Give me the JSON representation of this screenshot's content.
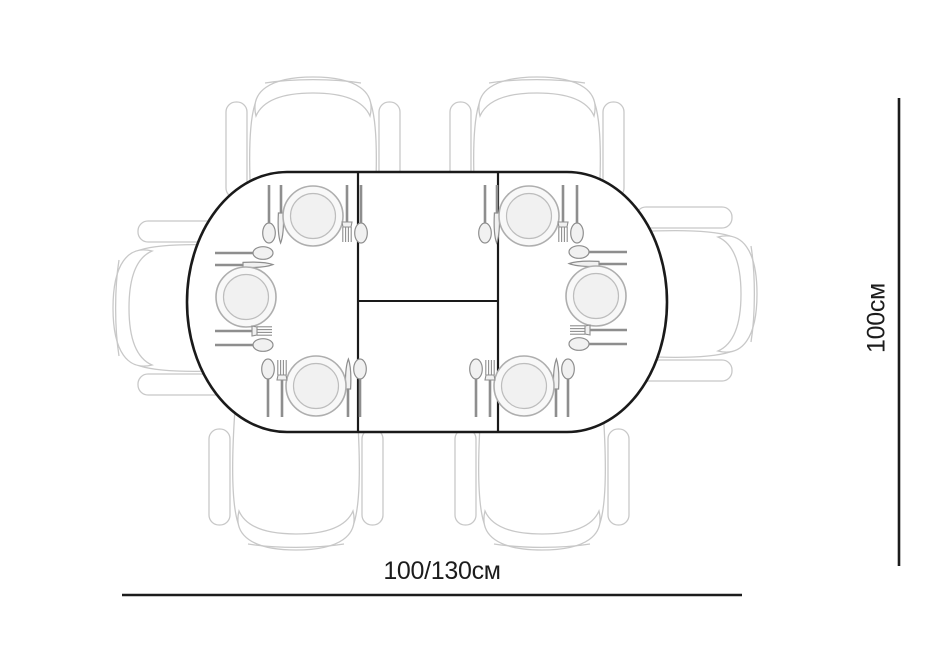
{
  "labels": {
    "width": "100/130см",
    "depth": "100см"
  },
  "table": {
    "shape": "oval extendable with center leaf",
    "place_settings": 6,
    "chairs": 6,
    "plates": 6
  },
  "colors": {
    "background": "#ffffff",
    "table_outline": "#1a1a1a",
    "dimension_line": "#1c1c1c",
    "chair_outline": "#c8c8c8",
    "plate_outline": "#aeaeae",
    "cutlery": "#8e8e8e"
  }
}
